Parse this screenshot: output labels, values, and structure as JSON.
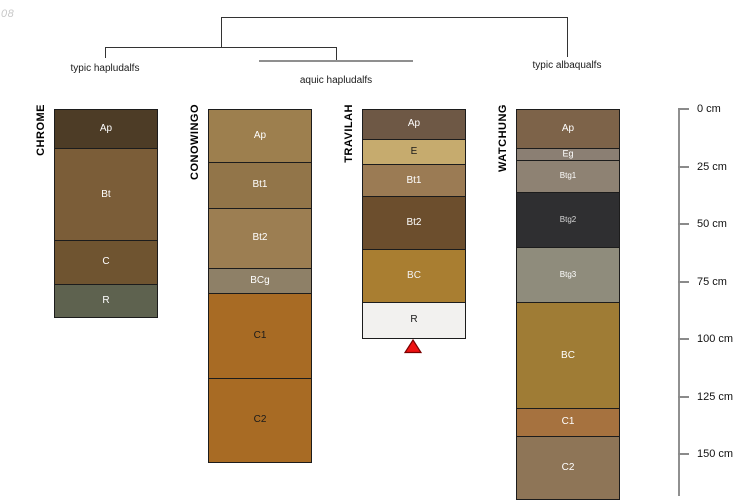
{
  "watermark": "08",
  "chart_data": {
    "type": "soil-profile-comparison",
    "depth_axis": {
      "unit": "cm",
      "tick_values": [
        0,
        25,
        50,
        75,
        100,
        125,
        150
      ],
      "tick_labels": [
        "0 cm",
        "25 cm",
        "50 cm",
        "75 cm",
        "100 cm",
        "125 cm",
        "150 cm"
      ]
    },
    "dendrogram": {
      "line_color": "#333333",
      "group_line_color": "#8f8f8f",
      "leaves": [
        {
          "profile": "CHROME",
          "classification": "typic hapludalfs"
        },
        {
          "profile": "CONOWINGO",
          "classification": "aquic hapludalfs"
        },
        {
          "profile": "TRAVILAH",
          "classification": "aquic hapludalfs"
        },
        {
          "profile": "WATCHUNG",
          "classification": "typic albaqualfs"
        }
      ],
      "labels": [
        {
          "text": "typic hapludalfs",
          "x": 105,
          "top": 63
        },
        {
          "text": "aquic hapludalfs",
          "x": 336,
          "top": 75
        },
        {
          "text": "typic albaqualfs",
          "x": 567,
          "top": 60
        }
      ]
    },
    "profiles": [
      {
        "name": "CHROME",
        "x_left": 54,
        "width": 102,
        "horizons": [
          {
            "name": "Ap",
            "top_cm": 0,
            "bottom_cm": 17,
            "color": "#4d3c26",
            "label_color": "#ffffff"
          },
          {
            "name": "Bt",
            "top_cm": 17,
            "bottom_cm": 57,
            "color": "#7b5d38",
            "label_color": "#ffffff"
          },
          {
            "name": "C",
            "top_cm": 57,
            "bottom_cm": 76,
            "color": "#6f5430",
            "label_color": "#ffffff"
          },
          {
            "name": "R",
            "top_cm": 76,
            "bottom_cm": 90,
            "color": "#5e624f",
            "label_color": "#ffffff"
          }
        ]
      },
      {
        "name": "CONOWINGO",
        "x_left": 208,
        "width": 102,
        "horizons": [
          {
            "name": "Ap",
            "top_cm": 0,
            "bottom_cm": 23,
            "color": "#9d7f4e",
            "label_color": "#ffffff"
          },
          {
            "name": "Bt1",
            "top_cm": 23,
            "bottom_cm": 43,
            "color": "#927549",
            "label_color": "#ffffff"
          },
          {
            "name": "Bt2",
            "top_cm": 43,
            "bottom_cm": 69,
            "color": "#9c7e52",
            "label_color": "#ffffff"
          },
          {
            "name": "BCg",
            "top_cm": 69,
            "bottom_cm": 80,
            "color": "#8e8067",
            "label_color": "#ffffff"
          },
          {
            "name": "C1",
            "top_cm": 80,
            "bottom_cm": 117,
            "color": "#a86b24",
            "label_color": "#1a1a1a"
          },
          {
            "name": "C2",
            "top_cm": 117,
            "bottom_cm": 153,
            "color": "#a86b24",
            "label_color": "#1a1a1a"
          }
        ]
      },
      {
        "name": "TRAVILAH",
        "x_left": 362,
        "width": 102,
        "marker": "red-triangle",
        "horizons": [
          {
            "name": "Ap",
            "top_cm": 0,
            "bottom_cm": 13,
            "color": "#6e5845",
            "label_color": "#ffffff"
          },
          {
            "name": "E",
            "top_cm": 13,
            "bottom_cm": 24,
            "color": "#c6ab6e",
            "label_color": "#1a1a1a"
          },
          {
            "name": "Bt1",
            "top_cm": 24,
            "bottom_cm": 38,
            "color": "#9b7b54",
            "label_color": "#ffffff"
          },
          {
            "name": "Bt2",
            "top_cm": 38,
            "bottom_cm": 61,
            "color": "#6c4e2d",
            "label_color": "#ffffff"
          },
          {
            "name": "BC",
            "top_cm": 61,
            "bottom_cm": 84,
            "color": "#a97e31",
            "label_color": "#f2f2f2"
          },
          {
            "name": "R",
            "top_cm": 84,
            "bottom_cm": 99,
            "color": "#f2f1ef",
            "label_color": "#1a1a1a"
          }
        ]
      },
      {
        "name": "WATCHUNG",
        "x_left": 516,
        "width": 102,
        "horizons": [
          {
            "name": "Ap",
            "top_cm": 0,
            "bottom_cm": 17,
            "color": "#7d6349",
            "label_color": "#ffffff",
            "label_size": 10
          },
          {
            "name": "Eg",
            "top_cm": 17,
            "bottom_cm": 22,
            "color": "#8b7f73",
            "label_color": "#ffffff",
            "label_size": 9
          },
          {
            "name": "Btg1",
            "top_cm": 22,
            "bottom_cm": 36,
            "color": "#8e8273",
            "label_color": "#ffffff",
            "label_size": 8
          },
          {
            "name": "Btg2",
            "top_cm": 36,
            "bottom_cm": 60,
            "color": "#2f2f31",
            "label_color": "#d8d8d8",
            "label_size": 8
          },
          {
            "name": "Btg3",
            "top_cm": 60,
            "bottom_cm": 84,
            "color": "#8f8c7c",
            "label_color": "#ffffff",
            "label_size": 8
          },
          {
            "name": "BC",
            "top_cm": 84,
            "bottom_cm": 130,
            "color": "#9f7c35",
            "label_color": "#ffffff",
            "label_size": 10
          },
          {
            "name": "C1",
            "top_cm": 130,
            "bottom_cm": 142,
            "color": "#a6723f",
            "label_color": "#ffffff",
            "label_size": 10
          },
          {
            "name": "C2",
            "top_cm": 142,
            "bottom_cm": 169,
            "color": "#8e7557",
            "label_color": "#ffffff",
            "label_size": 10
          }
        ]
      }
    ],
    "marker": {
      "shape": "triangle-up",
      "fill": "#ee1111",
      "stroke": "#7a0000"
    }
  }
}
